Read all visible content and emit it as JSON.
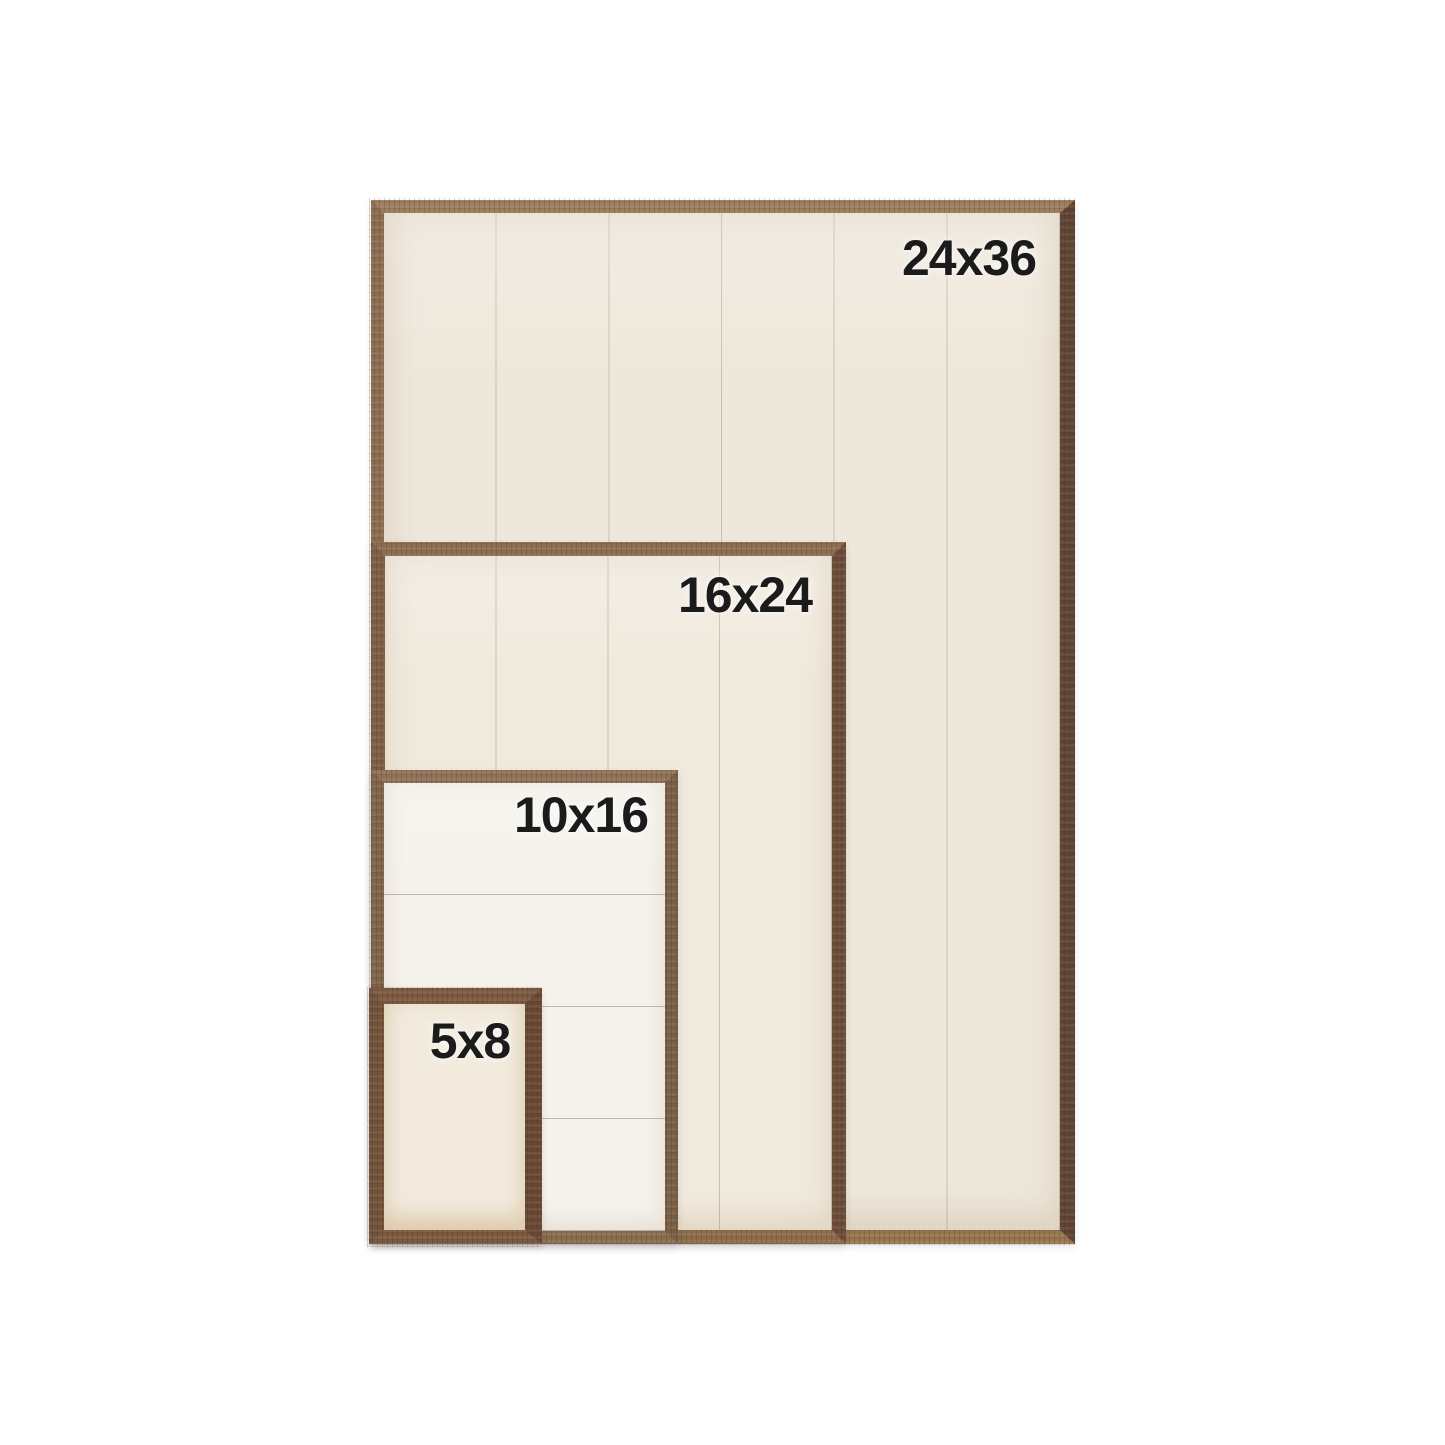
{
  "image_title": "Wood frame size comparison chart",
  "colors": {
    "page_background": "#ffffff",
    "label_text": "#1b1b1b",
    "wood_light": "#9d7e5d",
    "wood_dark": "#5f4433",
    "wood_small_frame": "#73523b",
    "panel_cream": "#eee7db",
    "panel_white": "#f5f2ec",
    "plank_line": "#9a8c76"
  },
  "frames": [
    {
      "label": "24x36",
      "planks": 6,
      "plank_direction": "vertical"
    },
    {
      "label": "16x24",
      "planks": 4,
      "plank_direction": "vertical"
    },
    {
      "label": "10x16",
      "planks": 4,
      "plank_direction": "horizontal"
    },
    {
      "label": "5x8",
      "planks": 1,
      "plank_direction": "none"
    }
  ]
}
